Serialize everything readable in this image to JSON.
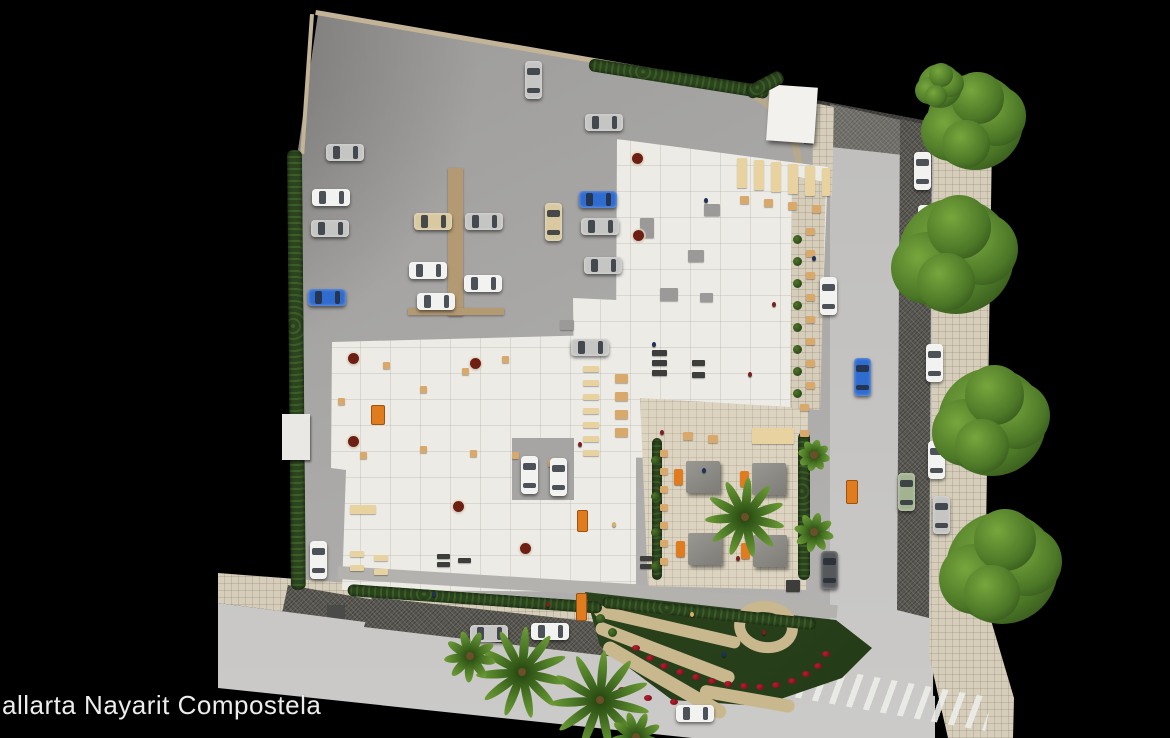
{
  "caption": "allarta Nayarit Compostela",
  "palette": {
    "background": "#000000",
    "asphalt": "#a6a5a3",
    "street": "#c6c5c3",
    "sidewalk": "#d6cebb",
    "building": "#edebe6",
    "terrace": "#dcd4c1",
    "hedge": "#2c451f",
    "tree_green": "#4e7a28",
    "palm_green": "#3f6b25",
    "cabana_gray": "#8b8984",
    "accent_orange": "#e07b1e",
    "flower_red": "#8e1222",
    "table_tan": "#d9a96b",
    "table_cream": "#e8d3a0",
    "car_colors": {
      "white": "#f2f2f0",
      "silver": "#c5c5c3",
      "blue": "#2f6cd0",
      "beige": "#d8c9a0",
      "green": "#a3b291",
      "dark": "#55575a",
      "gray": "#9a9a98"
    },
    "item_colors": {
      "tan": "#d9a96b",
      "cream": "#e8d3a0",
      "dark": "#3d3d3c",
      "gray": "#9b9a98"
    }
  },
  "cars": [
    {
      "x": 533,
      "y": 80,
      "o": "v",
      "c": "silver"
    },
    {
      "x": 604,
      "y": 122,
      "o": "h",
      "c": "silver"
    },
    {
      "x": 345,
      "y": 152,
      "o": "h",
      "c": "silver"
    },
    {
      "x": 331,
      "y": 197,
      "o": "h",
      "c": "white"
    },
    {
      "x": 330,
      "y": 228,
      "o": "h",
      "c": "silver"
    },
    {
      "x": 327,
      "y": 297,
      "o": "h",
      "c": "blue"
    },
    {
      "x": 433,
      "y": 221,
      "o": "h",
      "c": "beige"
    },
    {
      "x": 428,
      "y": 270,
      "o": "h",
      "c": "white"
    },
    {
      "x": 436,
      "y": 301,
      "o": "h",
      "c": "white"
    },
    {
      "x": 484,
      "y": 221,
      "o": "h",
      "c": "silver"
    },
    {
      "x": 483,
      "y": 283,
      "o": "h",
      "c": "white"
    },
    {
      "x": 553,
      "y": 222,
      "o": "v",
      "c": "beige"
    },
    {
      "x": 598,
      "y": 199,
      "o": "h",
      "c": "blue"
    },
    {
      "x": 600,
      "y": 226,
      "o": "h",
      "c": "silver"
    },
    {
      "x": 603,
      "y": 265,
      "o": "h",
      "c": "silver"
    },
    {
      "x": 590,
      "y": 347,
      "o": "h",
      "c": "silver"
    },
    {
      "x": 318,
      "y": 560,
      "o": "v",
      "c": "white"
    },
    {
      "x": 529,
      "y": 475,
      "o": "v",
      "c": "white"
    },
    {
      "x": 558,
      "y": 477,
      "o": "v",
      "c": "white"
    },
    {
      "x": 828,
      "y": 296,
      "o": "v",
      "c": "white"
    },
    {
      "x": 922,
      "y": 171,
      "o": "v",
      "c": "white"
    },
    {
      "x": 926,
      "y": 224,
      "o": "v",
      "c": "white"
    },
    {
      "x": 930,
      "y": 283,
      "o": "v",
      "c": "white"
    },
    {
      "x": 934,
      "y": 363,
      "o": "v",
      "c": "white"
    },
    {
      "x": 862,
      "y": 377,
      "o": "v",
      "c": "blue"
    },
    {
      "x": 936,
      "y": 460,
      "o": "v",
      "c": "white"
    },
    {
      "x": 906,
      "y": 492,
      "o": "v",
      "c": "green"
    },
    {
      "x": 941,
      "y": 515,
      "o": "v",
      "c": "silver"
    },
    {
      "x": 829,
      "y": 570,
      "o": "v",
      "c": "dark"
    },
    {
      "x": 489,
      "y": 633,
      "o": "h",
      "c": "silver"
    },
    {
      "x": 550,
      "y": 631,
      "o": "h",
      "c": "white"
    },
    {
      "x": 695,
      "y": 713,
      "o": "h",
      "c": "white"
    }
  ],
  "trees": [
    {
      "x": 975,
      "y": 122,
      "r": 48
    },
    {
      "x": 956,
      "y": 256,
      "r": 58
    },
    {
      "x": 992,
      "y": 422,
      "r": 54
    },
    {
      "x": 1002,
      "y": 568,
      "r": 56
    },
    {
      "x": 940,
      "y": 86,
      "r": 22
    }
  ],
  "palms": [
    {
      "x": 522,
      "y": 672,
      "r": 46,
      "n": 11
    },
    {
      "x": 600,
      "y": 700,
      "r": 50,
      "n": 11
    },
    {
      "x": 470,
      "y": 656,
      "r": 26,
      "n": 9
    },
    {
      "x": 745,
      "y": 517,
      "r": 40,
      "n": 11
    },
    {
      "x": 814,
      "y": 455,
      "r": 16,
      "n": 8
    },
    {
      "x": 814,
      "y": 532,
      "r": 20,
      "n": 8
    },
    {
      "x": 636,
      "y": 737,
      "r": 26,
      "n": 9
    }
  ],
  "cabanas": [
    {
      "x": 686,
      "y": 461
    },
    {
      "x": 752,
      "y": 463
    },
    {
      "x": 688,
      "y": 533
    },
    {
      "x": 753,
      "y": 535
    }
  ],
  "tables": [
    {
      "x": 737,
      "y": 158,
      "w": 10,
      "h": 30,
      "c": "cream"
    },
    {
      "x": 754,
      "y": 160,
      "w": 10,
      "h": 30,
      "c": "cream"
    },
    {
      "x": 771,
      "y": 162,
      "w": 10,
      "h": 30,
      "c": "cream"
    },
    {
      "x": 788,
      "y": 164,
      "w": 10,
      "h": 30,
      "c": "cream"
    },
    {
      "x": 805,
      "y": 166,
      "w": 10,
      "h": 30,
      "c": "cream"
    },
    {
      "x": 822,
      "y": 168,
      "w": 8,
      "h": 28,
      "c": "cream"
    },
    {
      "x": 740,
      "y": 196,
      "w": 9,
      "h": 8,
      "c": "tan"
    },
    {
      "x": 764,
      "y": 199,
      "w": 9,
      "h": 8,
      "c": "tan"
    },
    {
      "x": 788,
      "y": 202,
      "w": 9,
      "h": 8,
      "c": "tan"
    },
    {
      "x": 812,
      "y": 205,
      "w": 9,
      "h": 8,
      "c": "tan"
    },
    {
      "x": 806,
      "y": 228,
      "w": 9,
      "h": 7,
      "c": "tan"
    },
    {
      "x": 806,
      "y": 250,
      "w": 9,
      "h": 7,
      "c": "tan"
    },
    {
      "x": 806,
      "y": 272,
      "w": 9,
      "h": 7,
      "c": "tan"
    },
    {
      "x": 806,
      "y": 294,
      "w": 9,
      "h": 7,
      "c": "tan"
    },
    {
      "x": 806,
      "y": 316,
      "w": 9,
      "h": 7,
      "c": "tan"
    },
    {
      "x": 806,
      "y": 338,
      "w": 9,
      "h": 7,
      "c": "tan"
    },
    {
      "x": 806,
      "y": 360,
      "w": 9,
      "h": 7,
      "c": "tan"
    },
    {
      "x": 806,
      "y": 382,
      "w": 9,
      "h": 7,
      "c": "tan"
    },
    {
      "x": 800,
      "y": 404,
      "w": 9,
      "h": 7,
      "c": "tan"
    },
    {
      "x": 800,
      "y": 430,
      "w": 9,
      "h": 7,
      "c": "tan"
    },
    {
      "x": 583,
      "y": 366,
      "w": 16,
      "h": 6,
      "c": "cream"
    },
    {
      "x": 583,
      "y": 380,
      "w": 16,
      "h": 6,
      "c": "cream"
    },
    {
      "x": 583,
      "y": 394,
      "w": 16,
      "h": 6,
      "c": "cream"
    },
    {
      "x": 583,
      "y": 408,
      "w": 16,
      "h": 6,
      "c": "cream"
    },
    {
      "x": 583,
      "y": 422,
      "w": 16,
      "h": 6,
      "c": "cream"
    },
    {
      "x": 583,
      "y": 436,
      "w": 16,
      "h": 6,
      "c": "cream"
    },
    {
      "x": 583,
      "y": 450,
      "w": 16,
      "h": 6,
      "c": "cream"
    },
    {
      "x": 615,
      "y": 374,
      "w": 13,
      "h": 9,
      "c": "tan"
    },
    {
      "x": 615,
      "y": 392,
      "w": 13,
      "h": 9,
      "c": "tan"
    },
    {
      "x": 615,
      "y": 410,
      "w": 13,
      "h": 9,
      "c": "tan"
    },
    {
      "x": 615,
      "y": 428,
      "w": 13,
      "h": 9,
      "c": "tan"
    },
    {
      "x": 683,
      "y": 432,
      "w": 10,
      "h": 8,
      "c": "tan"
    },
    {
      "x": 708,
      "y": 435,
      "w": 10,
      "h": 8,
      "c": "tan"
    },
    {
      "x": 660,
      "y": 450,
      "w": 8,
      "h": 7,
      "c": "tan"
    },
    {
      "x": 660,
      "y": 468,
      "w": 8,
      "h": 7,
      "c": "tan"
    },
    {
      "x": 660,
      "y": 486,
      "w": 8,
      "h": 7,
      "c": "tan"
    },
    {
      "x": 660,
      "y": 504,
      "w": 8,
      "h": 7,
      "c": "tan"
    },
    {
      "x": 660,
      "y": 522,
      "w": 8,
      "h": 7,
      "c": "tan"
    },
    {
      "x": 660,
      "y": 540,
      "w": 8,
      "h": 7,
      "c": "tan"
    },
    {
      "x": 660,
      "y": 558,
      "w": 8,
      "h": 7,
      "c": "tan"
    },
    {
      "x": 350,
      "y": 551,
      "w": 14,
      "h": 6,
      "c": "cream"
    },
    {
      "x": 350,
      "y": 565,
      "w": 14,
      "h": 6,
      "c": "cream"
    },
    {
      "x": 374,
      "y": 555,
      "w": 14,
      "h": 6,
      "c": "cream"
    },
    {
      "x": 374,
      "y": 569,
      "w": 14,
      "h": 6,
      "c": "cream"
    },
    {
      "x": 350,
      "y": 505,
      "w": 26,
      "h": 9,
      "c": "cream"
    },
    {
      "x": 752,
      "y": 428,
      "w": 42,
      "h": 16,
      "c": "cream"
    },
    {
      "x": 652,
      "y": 350,
      "w": 15,
      "h": 6,
      "c": "dark"
    },
    {
      "x": 652,
      "y": 360,
      "w": 15,
      "h": 6,
      "c": "dark"
    },
    {
      "x": 652,
      "y": 370,
      "w": 15,
      "h": 6,
      "c": "dark"
    },
    {
      "x": 692,
      "y": 360,
      "w": 13,
      "h": 6,
      "c": "dark"
    },
    {
      "x": 692,
      "y": 372,
      "w": 13,
      "h": 6,
      "c": "dark"
    },
    {
      "x": 437,
      "y": 554,
      "w": 13,
      "h": 5,
      "c": "dark"
    },
    {
      "x": 437,
      "y": 562,
      "w": 13,
      "h": 5,
      "c": "dark"
    },
    {
      "x": 458,
      "y": 558,
      "w": 13,
      "h": 5,
      "c": "dark"
    },
    {
      "x": 640,
      "y": 556,
      "w": 12,
      "h": 5,
      "c": "dark"
    },
    {
      "x": 640,
      "y": 564,
      "w": 12,
      "h": 5,
      "c": "dark"
    },
    {
      "x": 786,
      "y": 580,
      "w": 14,
      "h": 12,
      "c": "dark"
    },
    {
      "x": 383,
      "y": 362,
      "w": 7,
      "h": 7,
      "c": "tan"
    },
    {
      "x": 420,
      "y": 386,
      "w": 7,
      "h": 7,
      "c": "tan"
    },
    {
      "x": 462,
      "y": 368,
      "w": 7,
      "h": 7,
      "c": "tan"
    },
    {
      "x": 502,
      "y": 356,
      "w": 7,
      "h": 7,
      "c": "tan"
    },
    {
      "x": 338,
      "y": 398,
      "w": 7,
      "h": 7,
      "c": "tan"
    },
    {
      "x": 360,
      "y": 452,
      "w": 7,
      "h": 7,
      "c": "tan"
    },
    {
      "x": 420,
      "y": 446,
      "w": 7,
      "h": 7,
      "c": "tan"
    },
    {
      "x": 470,
      "y": 450,
      "w": 7,
      "h": 7,
      "c": "tan"
    },
    {
      "x": 512,
      "y": 452,
      "w": 7,
      "h": 7,
      "c": "tan"
    },
    {
      "x": 548,
      "y": 460,
      "w": 7,
      "h": 7,
      "c": "tan"
    },
    {
      "x": 704,
      "y": 204,
      "w": 16,
      "h": 12,
      "c": "gray"
    },
    {
      "x": 688,
      "y": 250,
      "w": 16,
      "h": 12,
      "c": "gray"
    },
    {
      "x": 660,
      "y": 288,
      "w": 18,
      "h": 13,
      "c": "gray"
    },
    {
      "x": 700,
      "y": 293,
      "w": 13,
      "h": 9,
      "c": "gray"
    },
    {
      "x": 560,
      "y": 320,
      "w": 14,
      "h": 10,
      "c": "gray"
    },
    {
      "x": 640,
      "y": 218,
      "w": 14,
      "h": 20,
      "c": "gray"
    }
  ],
  "round_tables": [
    {
      "x": 353,
      "y": 358
    },
    {
      "x": 475,
      "y": 363
    },
    {
      "x": 353,
      "y": 441
    },
    {
      "x": 458,
      "y": 506
    },
    {
      "x": 525,
      "y": 548
    },
    {
      "x": 637,
      "y": 158
    },
    {
      "x": 638,
      "y": 235
    }
  ],
  "kiosks": [
    {
      "x": 371,
      "y": 405,
      "w": 12,
      "h": 18
    },
    {
      "x": 577,
      "y": 510,
      "w": 9,
      "h": 20
    },
    {
      "x": 846,
      "y": 480,
      "w": 10,
      "h": 22
    },
    {
      "x": 576,
      "y": 593,
      "w": 9,
      "h": 26
    }
  ],
  "bushes": [
    {
      "x": 797,
      "y": 239
    },
    {
      "x": 797,
      "y": 261
    },
    {
      "x": 797,
      "y": 283
    },
    {
      "x": 797,
      "y": 305
    },
    {
      "x": 797,
      "y": 327
    },
    {
      "x": 797,
      "y": 349
    },
    {
      "x": 797,
      "y": 371
    },
    {
      "x": 797,
      "y": 393
    },
    {
      "x": 655,
      "y": 460
    },
    {
      "x": 655,
      "y": 496
    },
    {
      "x": 655,
      "y": 532
    },
    {
      "x": 655,
      "y": 566
    },
    {
      "x": 600,
      "y": 618
    },
    {
      "x": 612,
      "y": 632
    }
  ],
  "flowers": [
    {
      "x": 636,
      "y": 648
    },
    {
      "x": 650,
      "y": 658
    },
    {
      "x": 664,
      "y": 666
    },
    {
      "x": 680,
      "y": 672
    },
    {
      "x": 696,
      "y": 677
    },
    {
      "x": 712,
      "y": 681
    },
    {
      "x": 728,
      "y": 684
    },
    {
      "x": 744,
      "y": 686
    },
    {
      "x": 760,
      "y": 687
    },
    {
      "x": 776,
      "y": 685
    },
    {
      "x": 792,
      "y": 681
    },
    {
      "x": 806,
      "y": 674
    },
    {
      "x": 818,
      "y": 666
    },
    {
      "x": 826,
      "y": 654
    },
    {
      "x": 622,
      "y": 690
    },
    {
      "x": 648,
      "y": 698
    },
    {
      "x": 674,
      "y": 702
    }
  ],
  "people": [
    {
      "x": 660,
      "y": 430,
      "c": "#7a2020"
    },
    {
      "x": 702,
      "y": 468,
      "c": "#20305a"
    },
    {
      "x": 736,
      "y": 556,
      "c": "#7a2020"
    },
    {
      "x": 690,
      "y": 612,
      "c": "#d8b06a"
    },
    {
      "x": 722,
      "y": 652,
      "c": "#20305a"
    },
    {
      "x": 762,
      "y": 630,
      "c": "#7a2020"
    },
    {
      "x": 652,
      "y": 342,
      "c": "#20305a"
    },
    {
      "x": 772,
      "y": 302,
      "c": "#7a2020"
    },
    {
      "x": 812,
      "y": 256,
      "c": "#20305a"
    },
    {
      "x": 546,
      "y": 602,
      "c": "#7a2020"
    },
    {
      "x": 432,
      "y": 592,
      "c": "#20305a"
    },
    {
      "x": 612,
      "y": 522,
      "c": "#d8b06a"
    },
    {
      "x": 578,
      "y": 442,
      "c": "#7a2020"
    },
    {
      "x": 704,
      "y": 198,
      "c": "#20305a"
    },
    {
      "x": 748,
      "y": 372,
      "c": "#7a2020"
    }
  ]
}
